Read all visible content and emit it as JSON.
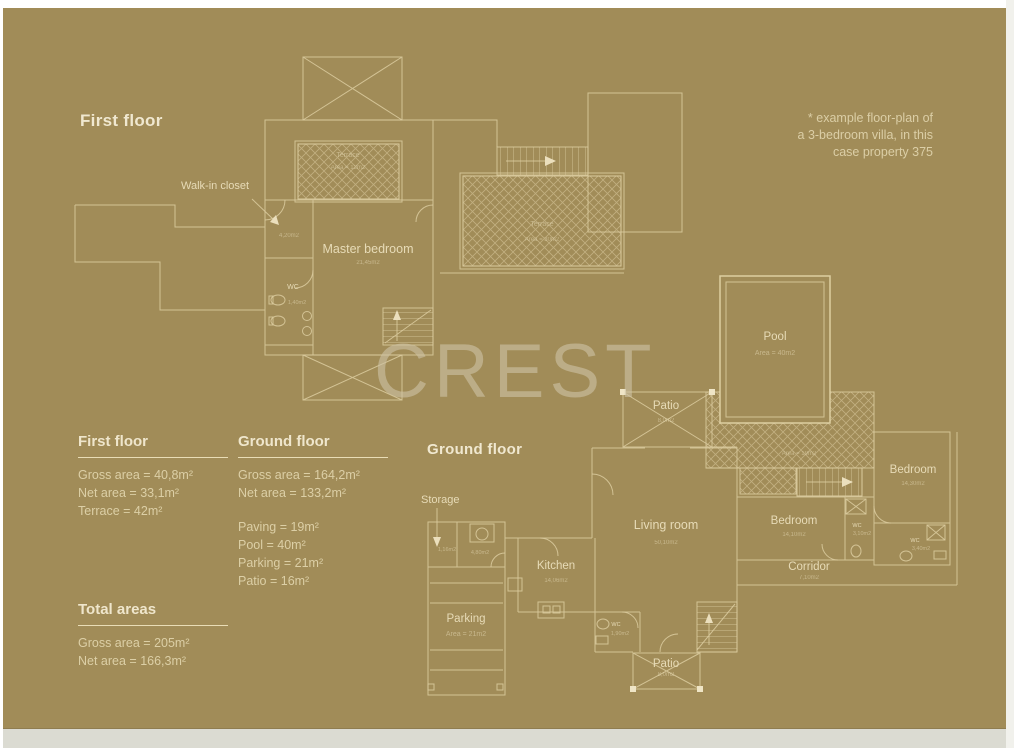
{
  "colors": {
    "background": "#A18C58",
    "line": "#DCCCA0",
    "text": "#E7DBB7",
    "heading": "#F0E8D0"
  },
  "watermark": "CREST",
  "note": {
    "line1": "* example floor-plan of",
    "line2": "a 3-bedroom villa, in this",
    "line3": "case property 375"
  },
  "first_floor": {
    "heading": "First floor",
    "walk_in_closet": "Walk-in closet",
    "closet_area": "4,20m2",
    "master_bedroom": "Master bedroom",
    "master_bedroom_area": "21,45m2",
    "wc": "WC",
    "wc_area": "1,40m2",
    "terrace_small": "Terrace",
    "terrace_small_area": "Area = 12m2",
    "terrace_large": "Terrace",
    "terrace_large_area": "Area = 30m2"
  },
  "ground_floor": {
    "heading": "Ground floor",
    "storage": "Storage",
    "storage_a_area": "1,16m2",
    "storage_b_area": "4,80m2",
    "pool": "Pool",
    "pool_area": "Area = 40m2",
    "paving_area": "Area = 19m2",
    "patio_top": "Patio",
    "patio_top_area": "8,0m2",
    "patio_bottom": "Patio",
    "patio_bottom_area": "8,0m2",
    "living_room": "Living room",
    "living_room_area": "50,10m2",
    "kitchen": "Kitchen",
    "kitchen_area": "14,06m2",
    "parking": "Parking",
    "parking_area": "Area = 21m2",
    "bedroom_mid": "Bedroom",
    "bedroom_mid_area": "14,10m2",
    "bedroom_right": "Bedroom",
    "bedroom_right_area": "14,30m2",
    "corridor": "Corridor",
    "corridor_area": "7,10m2",
    "wc_mid": "WC",
    "wc_mid_area": "3,10m2",
    "wc_right": "WC",
    "wc_right_area": "3,40m2",
    "wc_patio": "WC",
    "wc_patio_area": "1,90m2"
  },
  "stats": {
    "first_floor": {
      "title": "First floor",
      "rows": [
        "Gross area = 40,8m²",
        "Net area = 33,1m²",
        "Terrace = 42m²"
      ]
    },
    "ground_floor": {
      "title": "Ground floor",
      "rows_top": [
        "Gross area = 164,2m²",
        "Net area = 133,2m²"
      ],
      "rows_bottom": [
        "Paving = 19m²",
        "Pool = 40m²",
        "Parking = 21m²",
        "Patio = 16m²"
      ]
    },
    "totals": {
      "title": "Total areas",
      "rows": [
        "Gross area = 205m²",
        "Net area = 166,3m²"
      ]
    }
  }
}
